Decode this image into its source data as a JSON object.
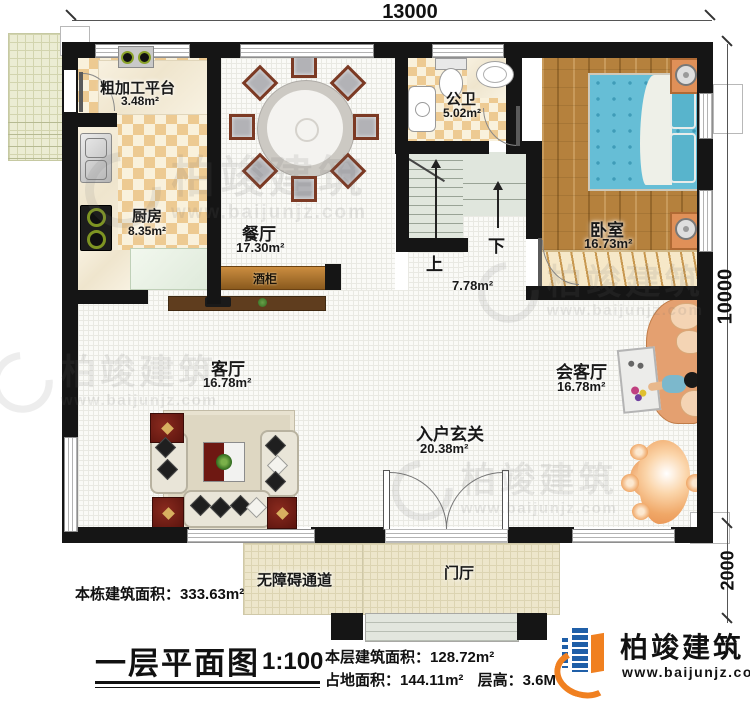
{
  "dims": {
    "top": "13000",
    "right_upper": "10000",
    "right_lower": "2000"
  },
  "rooms": {
    "rough": {
      "name": "粗加工平台",
      "area": "3.48m²"
    },
    "kitchen": {
      "name": "厨房",
      "area": "8.35m²"
    },
    "dining": {
      "name": "餐厅",
      "area": "17.30m²"
    },
    "bath": {
      "name": "公卫",
      "area": "5.02m²"
    },
    "bedroom": {
      "name": "卧室",
      "area": "16.73m²"
    },
    "living": {
      "name": "客厅",
      "area": "16.78m²"
    },
    "reception": {
      "name": "会客厅",
      "area": "16.78m²"
    },
    "foyer": {
      "name": "入户玄关",
      "area": "20.38m²"
    },
    "stair": {
      "area": "7.78m²",
      "up": "上",
      "down": "下"
    },
    "wine": {
      "name": "酒柜"
    },
    "porch": {
      "name": "门厅"
    },
    "ramp": {
      "name": "无障碍通道"
    }
  },
  "stats": {
    "building_total_label": "本栋建筑面积：",
    "building_total_value": "333.63m²",
    "floor_label": "本层建筑面积：",
    "floor_value": "128.72m²",
    "footprint_label": "占地面积：",
    "footprint_value": "144.11m²",
    "height_label": "层高：",
    "height_value": "3.6M"
  },
  "title_block": {
    "title": "一层平面图",
    "scale": "1:100"
  },
  "brand": {
    "name": "柏竣建筑",
    "url": "www.baijunjz.com"
  },
  "watermark": {
    "name": "柏竣建筑",
    "url": "www.baijunjz.com"
  },
  "colors": {
    "wall": "#151515",
    "checker_tan": "#edca92",
    "wood": "#b5813d",
    "bed_blue": "#66bed6",
    "logo_blue": "#1f5fa8",
    "logo_orange": "#f08020"
  }
}
